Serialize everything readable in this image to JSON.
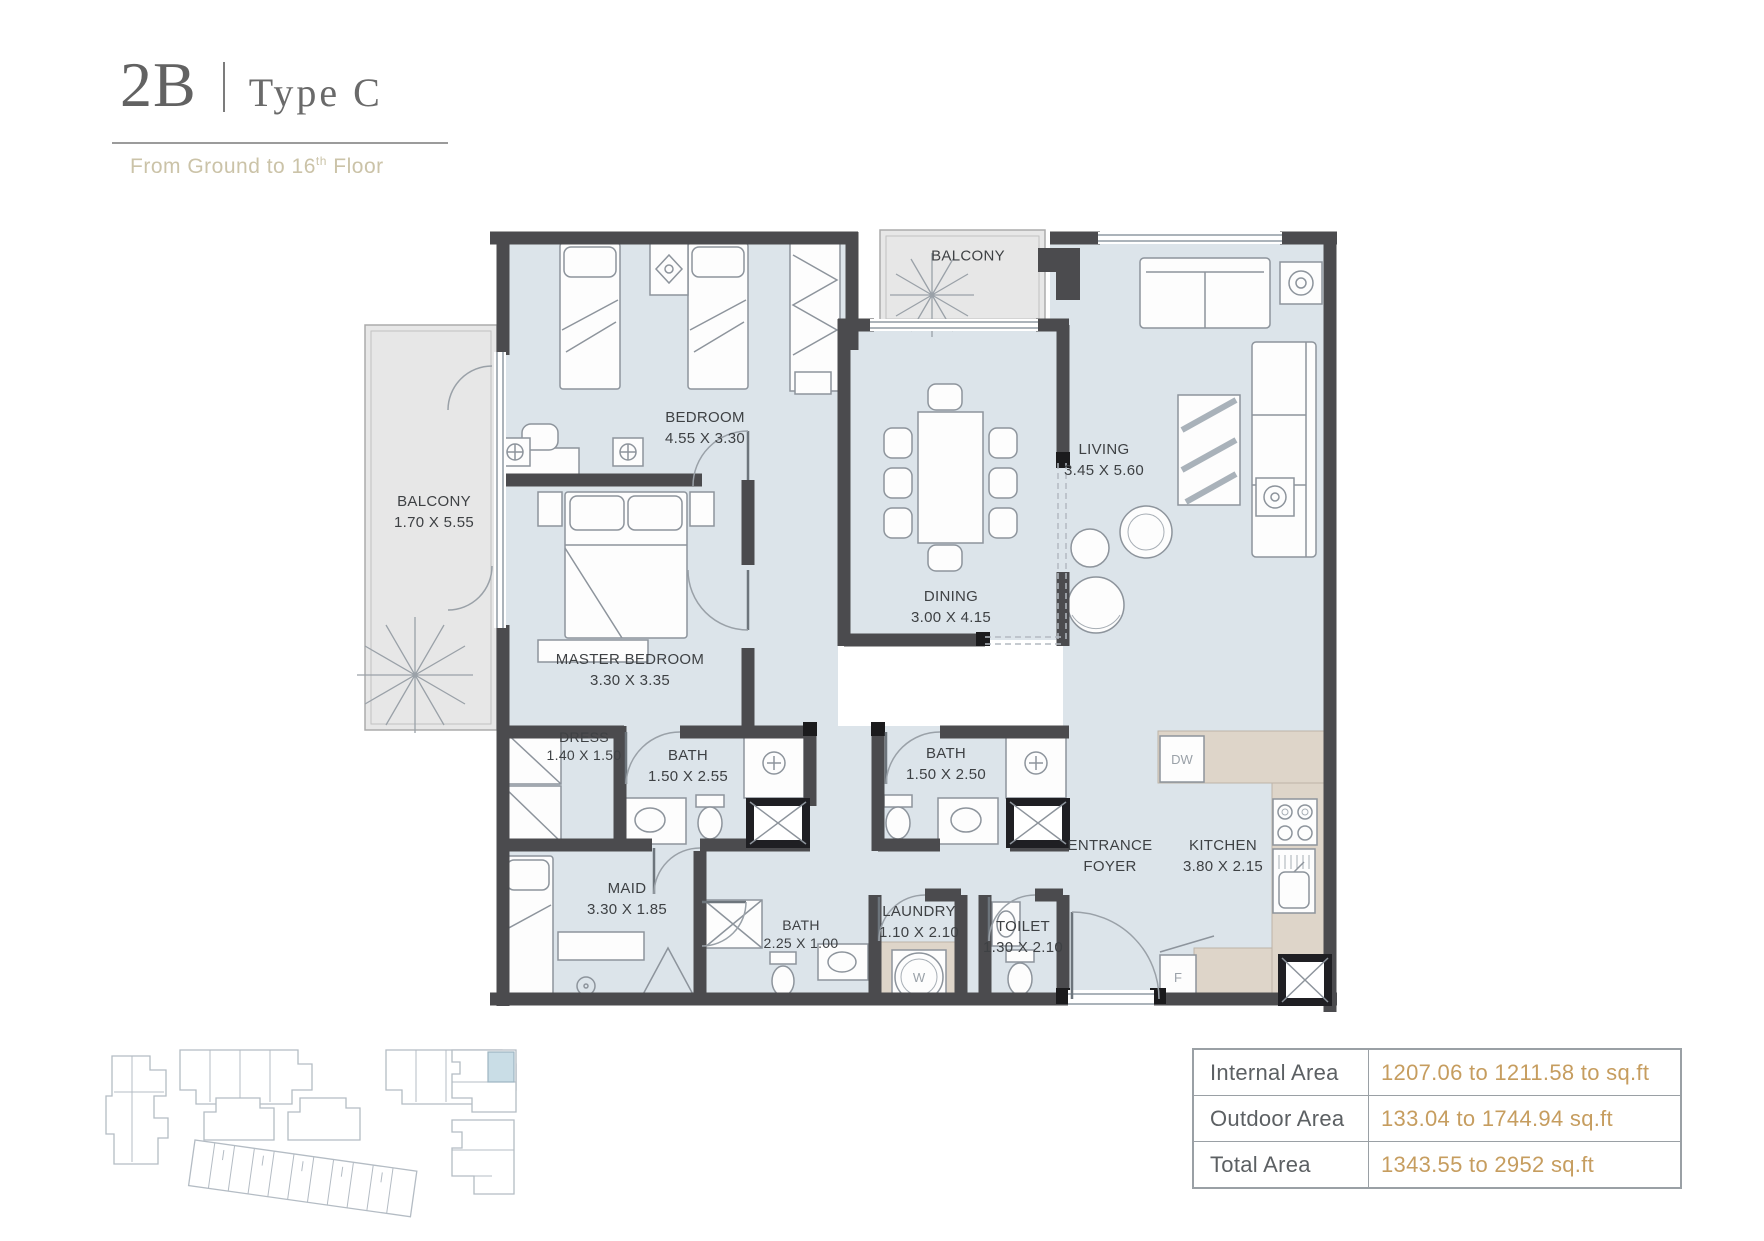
{
  "title": {
    "code": "2B",
    "divider": "|",
    "variant": "Type C",
    "subtitle_prefix": "From Ground to 16",
    "subtitle_sup": "th",
    "subtitle_suffix": " Floor"
  },
  "rooms": [
    {
      "id": "bedroom",
      "name": "BEDROOM",
      "dims": "4.55 X 3.30"
    },
    {
      "id": "balcony-top",
      "name": "BALCONY",
      "dims": ""
    },
    {
      "id": "living",
      "name": "LIVING",
      "dims": "3.45 X 5.60"
    },
    {
      "id": "balcony-left",
      "name": "BALCONY",
      "dims": "1.70 X 5.55"
    },
    {
      "id": "master-bedroom",
      "name": "MASTER BEDROOM",
      "dims": "3.30 X 3.35"
    },
    {
      "id": "dining",
      "name": "DINING",
      "dims": "3.00 X 4.15"
    },
    {
      "id": "dress",
      "name": "DRESS",
      "dims": "1.40 X 1.50"
    },
    {
      "id": "bath-1",
      "name": "BATH",
      "dims": "1.50 X 2.55"
    },
    {
      "id": "bath-2",
      "name": "BATH",
      "dims": "1.50 X 2.50"
    },
    {
      "id": "entrance-foyer",
      "name": "ENTRANCE FOYER",
      "dims": ""
    },
    {
      "id": "kitchen",
      "name": "KITCHEN",
      "dims": "3.80 X 2.15"
    },
    {
      "id": "maid",
      "name": "MAID",
      "dims": "3.30 X 1.85"
    },
    {
      "id": "bath-3",
      "name": "BATH",
      "dims": "2.25 X 1.00"
    },
    {
      "id": "laundry",
      "name": "LAUNDRY",
      "dims": "1.10 X 2.10"
    },
    {
      "id": "toilet",
      "name": "TOILET",
      "dims": "1.30 X 2.10"
    }
  ],
  "appliances": {
    "dishwasher": "DW",
    "fridge": "F",
    "washer": "W"
  },
  "area_table": {
    "rows": [
      {
        "label": "Internal Area",
        "value": "1207.06 to 1211.58 to sq.ft"
      },
      {
        "label": "Outdoor Area",
        "value": "133.04 to 1744.94 sq.ft"
      },
      {
        "label": "Total Area",
        "value": "1343.55 to 2952 sq.ft"
      }
    ]
  },
  "colors": {
    "accent_gold": "#c69d5f",
    "wall_gray": "#4b4b4e",
    "floor_blue": "#dce4ea",
    "balcony_gray": "#e7e7e7",
    "counter_beige": "#ded5c9",
    "label_text": "#3e4144"
  }
}
